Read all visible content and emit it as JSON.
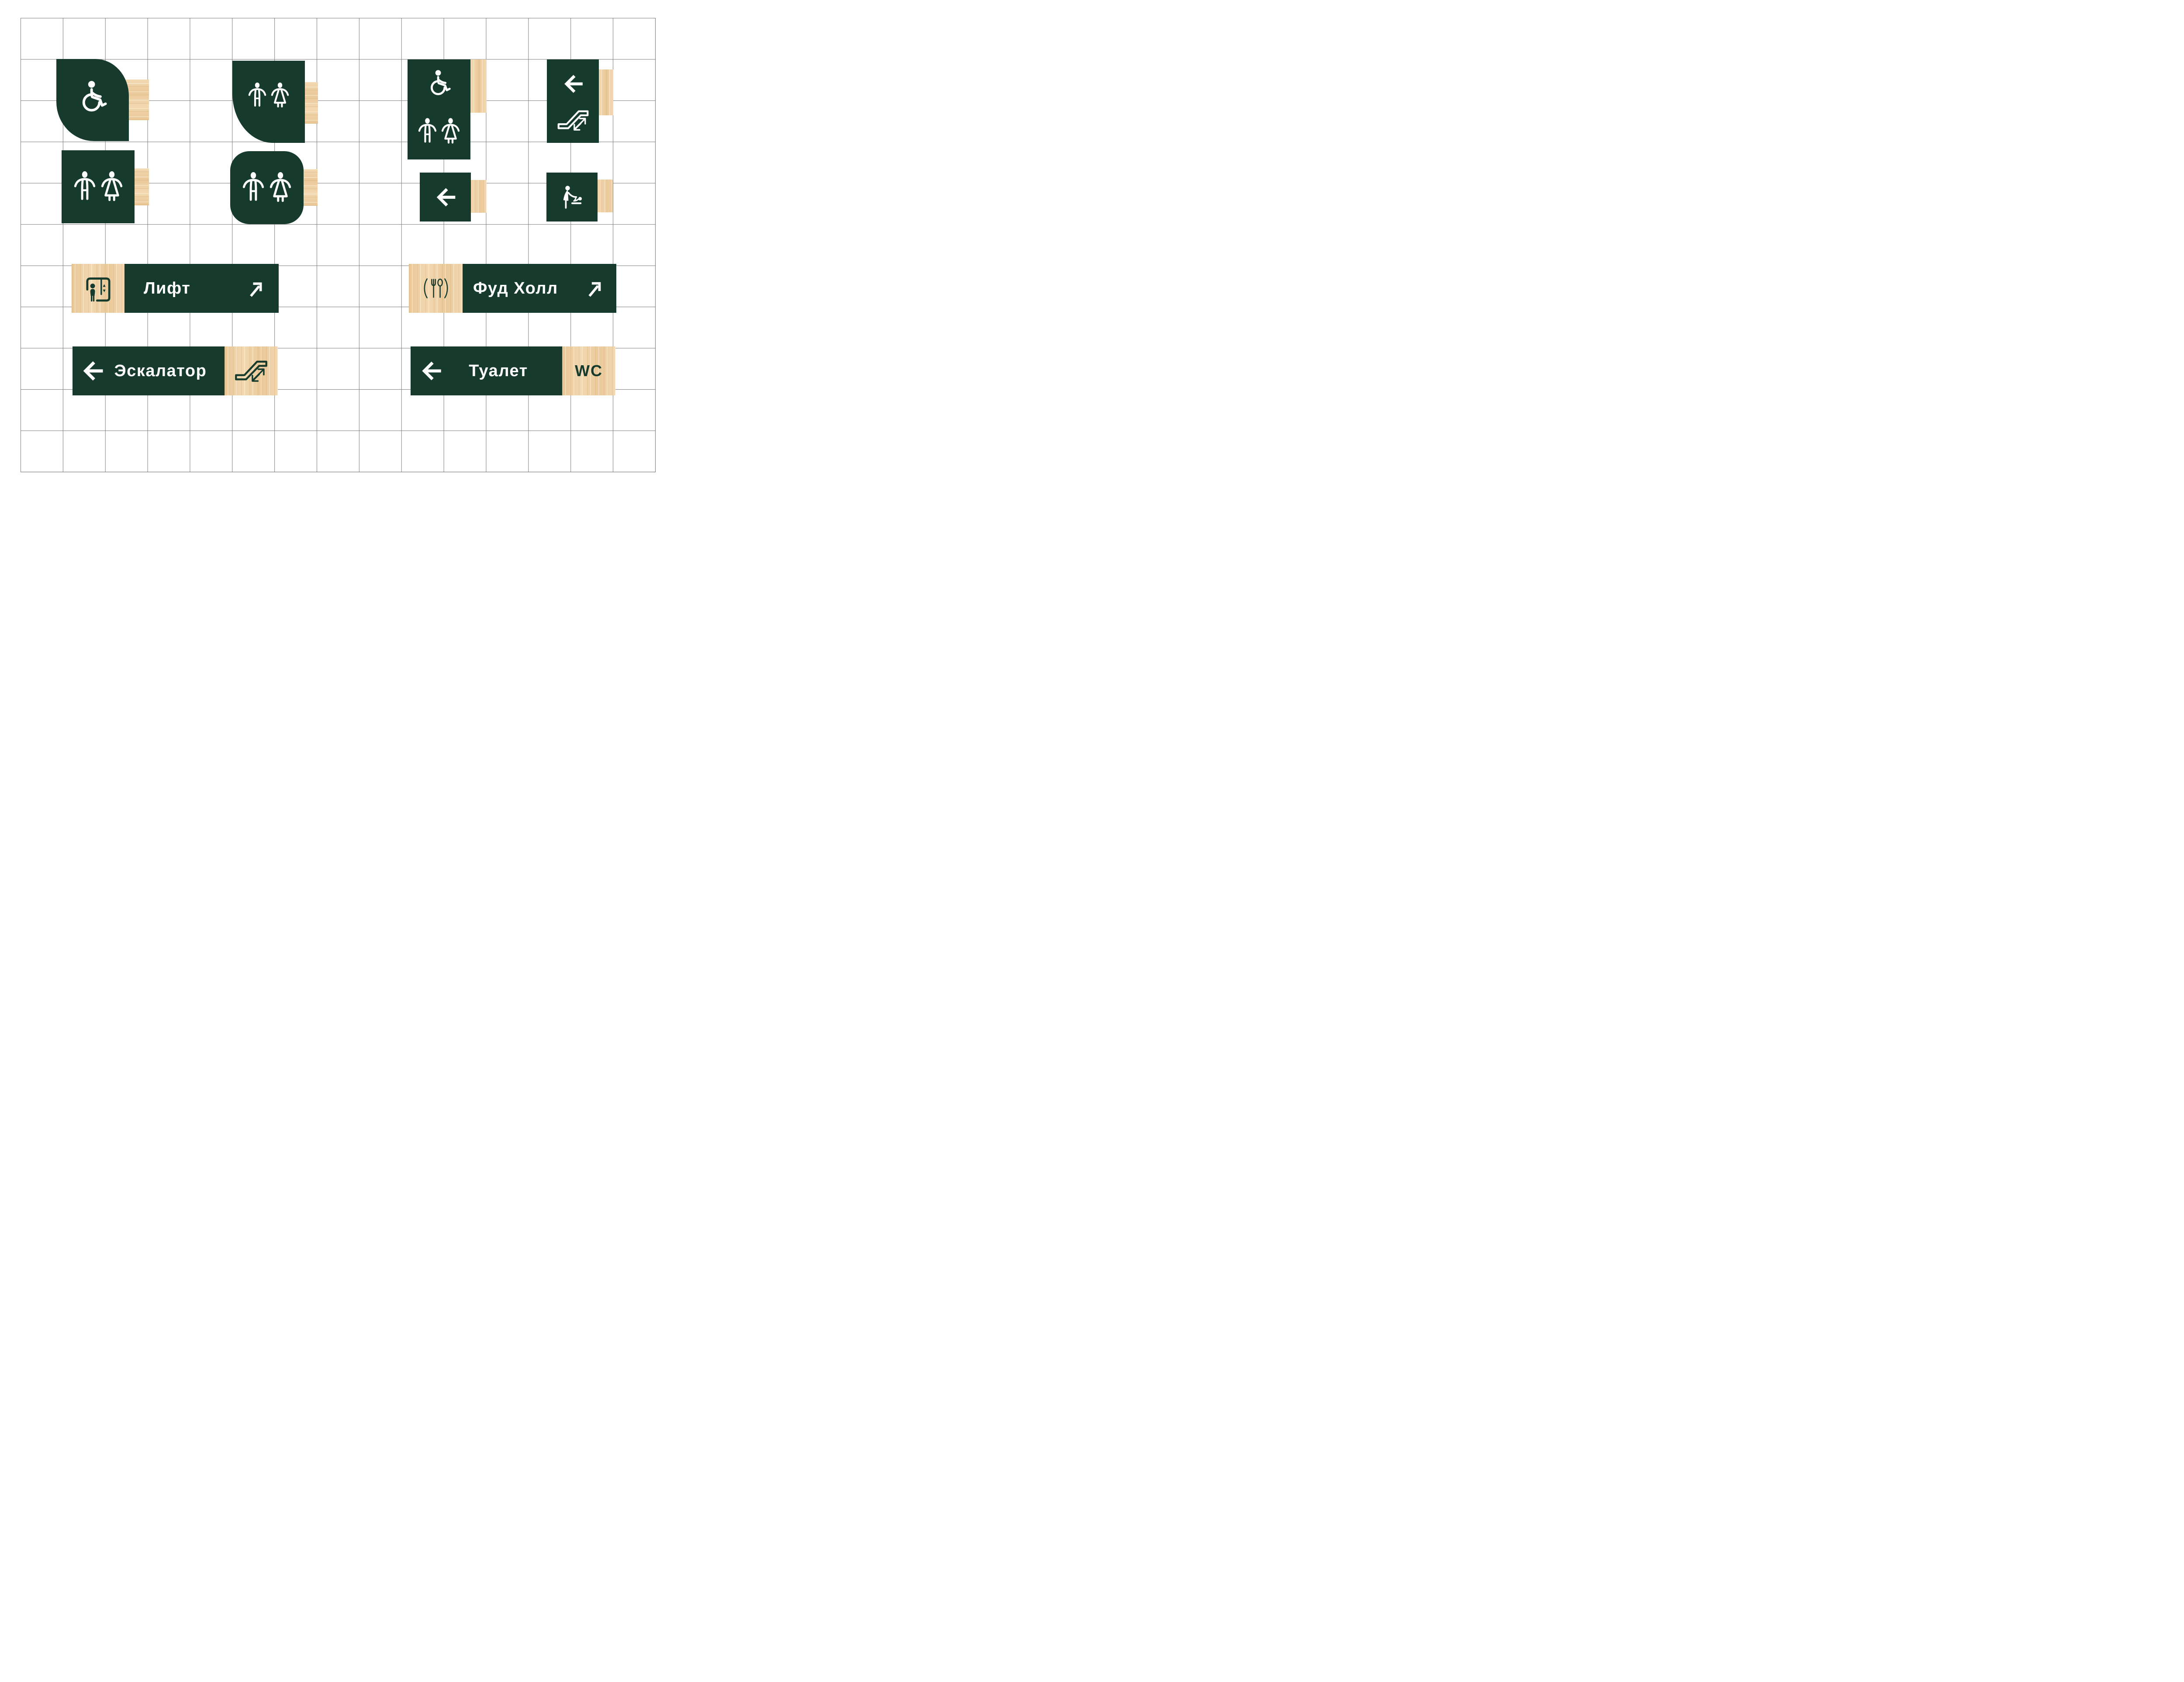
{
  "title": "Wayfinding signage design sheet",
  "palette": {
    "green": "#163A2C",
    "wood": "#EFD2A8",
    "grid_line": "#7B7B7B",
    "background": "#FFFFFF",
    "pictogram": "#FFFFFF"
  },
  "signs": {
    "accessible_leaf": {
      "icons": [
        "wheelchair-icon"
      ]
    },
    "wc_leaf": {
      "icons": [
        "man-icon",
        "woman-icon"
      ]
    },
    "wc_accessible_panel": {
      "icons": [
        "wheelchair-icon",
        "man-icon",
        "woman-icon"
      ]
    },
    "escalator_direction_panel": {
      "icons": [
        "arrow-left-icon",
        "escalator-icon"
      ]
    },
    "wc_square": {
      "icons": [
        "man-icon",
        "woman-icon"
      ]
    },
    "wc_rounded_square": {
      "icons": [
        "man-icon",
        "woman-icon"
      ]
    },
    "direction_small": {
      "icons": [
        "arrow-left-icon"
      ]
    },
    "baby_changing": {
      "icons": [
        "baby-changing-icon"
      ]
    },
    "lift": {
      "label": "Лифт",
      "icons": [
        "elevator-icon",
        "arrow-up-right-icon"
      ]
    },
    "food_hall": {
      "label": "Фуд Холл",
      "icons": [
        "cutlery-icon",
        "arrow-up-right-icon"
      ]
    },
    "escalator": {
      "label": "Эскалатор",
      "icons": [
        "arrow-left-icon",
        "escalator-icon"
      ]
    },
    "toilet": {
      "label": "Туалет",
      "wc_label": "WC",
      "icons": [
        "arrow-left-icon"
      ]
    }
  }
}
